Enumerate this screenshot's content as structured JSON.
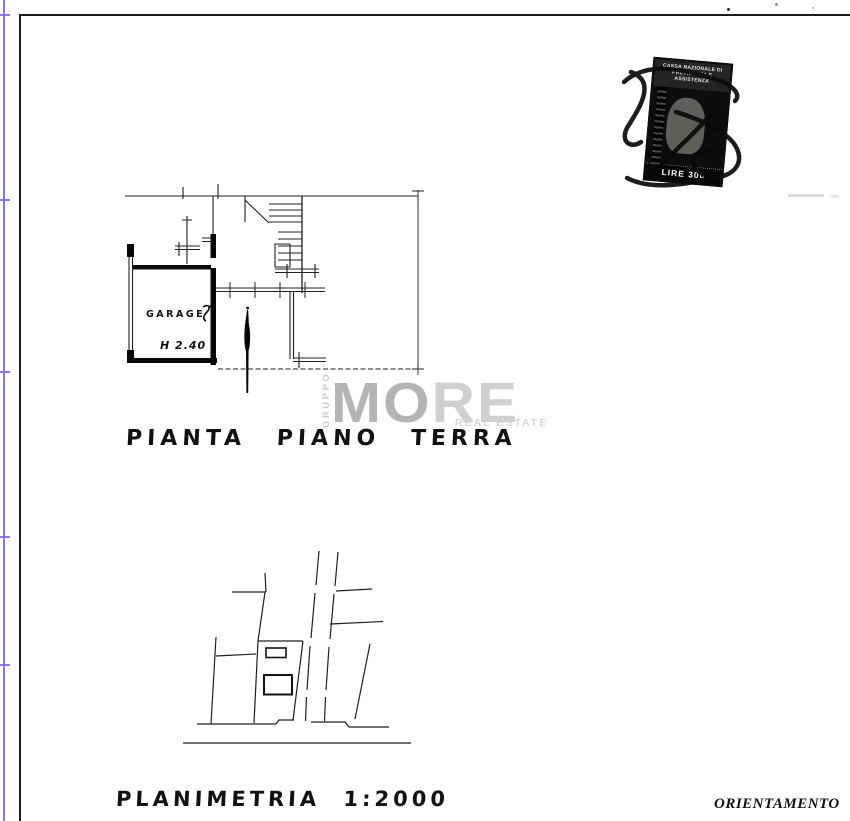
{
  "document": {
    "stamp": {
      "header_line1": "CASSA NAZIONALE DI",
      "header_line2": "PREVIDENZA E ASSISTENZA",
      "denomination": "LIRE 300"
    },
    "watermark": {
      "vertical_text": "GRUPPO",
      "brand_mo": "MO",
      "brand_re": "RE",
      "tagline": "REAL ESTATE",
      "color_dark": "#b4b4b4",
      "color_light": "#d0d0d0"
    },
    "floor_plan": {
      "caption": "PIANTA PIANO TERRA",
      "room_label": "GARAGE",
      "height_annotation": "H 2.40"
    },
    "site_plan": {
      "caption": "PLANIMETRIA 1:2000"
    },
    "orientation_label": "ORIENTAMENTO",
    "colors": {
      "ink": "#1f1f1f",
      "scan_edge_blue": "#8377ec"
    }
  }
}
